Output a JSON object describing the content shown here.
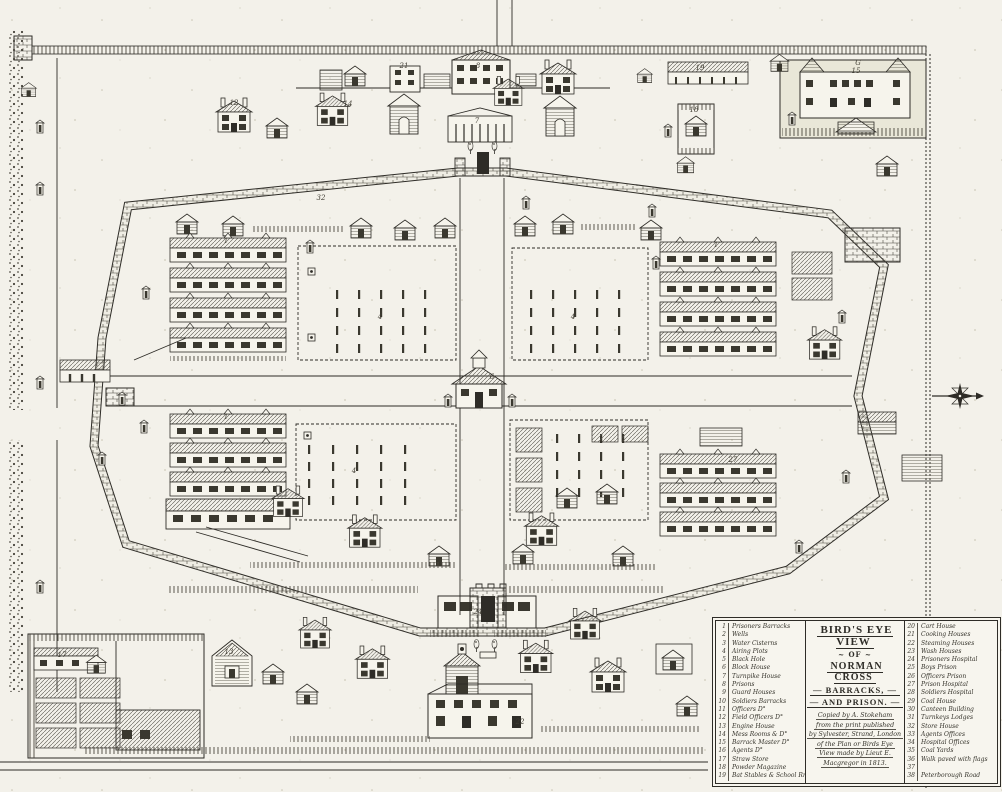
{
  "page": {
    "background": "#f3f1ea",
    "ink": "#2e2c27",
    "enclosure_fill": "#e9e7d8"
  },
  "legend": {
    "title_lines": [
      "BIRD'S EYE VIEW",
      "~ OF ~",
      "NORMAN CROSS",
      "— BARRACKS, —",
      "— AND PRISON. —"
    ],
    "caption_lines": [
      "Copied by A. Stokeham",
      "from the print published",
      "by Sylvester, Strand, London",
      "of the Plan or Birds Eye",
      "View made by Lieut E.",
      "Macgregor in 1813."
    ],
    "left_items": [
      {
        "n": "1",
        "label": "Prisoners Barracks"
      },
      {
        "n": "2",
        "label": "Wells"
      },
      {
        "n": "3",
        "label": "Water Cisterns"
      },
      {
        "n": "4",
        "label": "Airing Plots"
      },
      {
        "n": "5",
        "label": "Black Hole"
      },
      {
        "n": "6",
        "label": "Block House"
      },
      {
        "n": "7",
        "label": "Turnpike House"
      },
      {
        "n": "8",
        "label": "Prisons"
      },
      {
        "n": "9",
        "label": "Guard Houses"
      },
      {
        "n": "10",
        "label": "Soldiers Barracks"
      },
      {
        "n": "11",
        "label": "Officers D°"
      },
      {
        "n": "12",
        "label": "Field Officers D°"
      },
      {
        "n": "13",
        "label": "Engine House"
      },
      {
        "n": "14",
        "label": "Mess Rooms & D°"
      },
      {
        "n": "15",
        "label": "Barrack Master D°"
      },
      {
        "n": "16",
        "label": "Agents D°"
      },
      {
        "n": "17",
        "label": "Straw Store"
      },
      {
        "n": "18",
        "label": "Powder Magazine"
      },
      {
        "n": "19",
        "label": "Bat Stables & School Rm"
      }
    ],
    "right_items": [
      {
        "n": "20",
        "label": "Cart House"
      },
      {
        "n": "21",
        "label": "Cooking Houses"
      },
      {
        "n": "22",
        "label": "Steaming Houses"
      },
      {
        "n": "23",
        "label": "Wash Houses"
      },
      {
        "n": "24",
        "label": "Prisoners Hospital"
      },
      {
        "n": "25",
        "label": "Boys Prison"
      },
      {
        "n": "26",
        "label": "Officers Prison"
      },
      {
        "n": "27",
        "label": "Prison Hospital"
      },
      {
        "n": "28",
        "label": "Soldiers Hospital"
      },
      {
        "n": "29",
        "label": "Coal House"
      },
      {
        "n": "30",
        "label": "Canteen Building"
      },
      {
        "n": "31",
        "label": "Turnkeys Lodges"
      },
      {
        "n": "32",
        "label": "Store House"
      },
      {
        "n": "33",
        "label": "Agents Offices"
      },
      {
        "n": "34",
        "label": "Hospital Offices"
      },
      {
        "n": "35",
        "label": "Coal Yards"
      },
      {
        "n": "36",
        "label": "Walk paved with flags"
      },
      {
        "n": "37",
        "label": ""
      },
      {
        "n": "38",
        "label": "Peterborough Road"
      }
    ]
  },
  "map_labels": [
    {
      "t": "12",
      "x": 234,
      "y": 103
    },
    {
      "t": "8",
      "x": 478,
      "y": 66
    },
    {
      "t": "7",
      "x": 477,
      "y": 121
    },
    {
      "t": "14",
      "x": 348,
      "y": 104
    },
    {
      "t": "21",
      "x": 404,
      "y": 66
    },
    {
      "t": "19",
      "x": 700,
      "y": 68
    },
    {
      "t": "18",
      "x": 694,
      "y": 110
    },
    {
      "t": "G",
      "x": 858,
      "y": 63
    },
    {
      "t": "15",
      "x": 856,
      "y": 71
    },
    {
      "t": "32",
      "x": 321,
      "y": 198
    },
    {
      "t": "1",
      "x": 226,
      "y": 241
    },
    {
      "t": "1",
      "x": 716,
      "y": 245
    },
    {
      "t": "4",
      "x": 380,
      "y": 317
    },
    {
      "t": "4",
      "x": 573,
      "y": 317
    },
    {
      "t": "6",
      "x": 492,
      "y": 377
    },
    {
      "t": "1",
      "x": 226,
      "y": 417
    },
    {
      "t": "4",
      "x": 354,
      "y": 471
    },
    {
      "t": "27",
      "x": 733,
      "y": 460
    },
    {
      "t": "24",
      "x": 478,
      "y": 612
    },
    {
      "t": "13",
      "x": 229,
      "y": 652
    },
    {
      "t": "17",
      "x": 62,
      "y": 655
    },
    {
      "t": "22",
      "x": 520,
      "y": 722
    }
  ]
}
